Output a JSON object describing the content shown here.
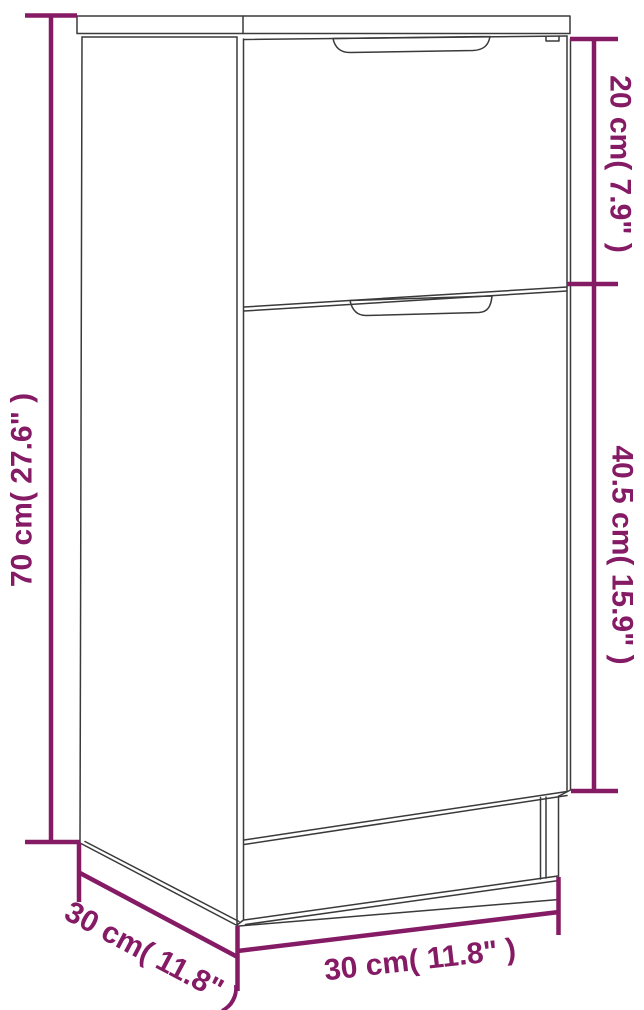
{
  "colors": {
    "dimension_accent": "#851A65",
    "outline": "#3A3A3A",
    "background": "#FFFFFF"
  },
  "dimensions": {
    "overall_height": {
      "label": "70 cm( 27.6\" )",
      "cm": 70,
      "inches": 27.6
    },
    "drawer_section_height": {
      "label": "20 cm( 7.9\" )",
      "cm": 20,
      "inches": 7.9
    },
    "door_section_height": {
      "label": "40.5 cm( 15.9\" )",
      "cm": 40.5,
      "inches": 15.9
    },
    "width": {
      "label": "30 cm( 11.8\" )",
      "cm": 30,
      "inches": 11.8
    },
    "depth": {
      "label": "30 cm( 11.8\" )",
      "cm": 30,
      "inches": 11.8
    }
  }
}
